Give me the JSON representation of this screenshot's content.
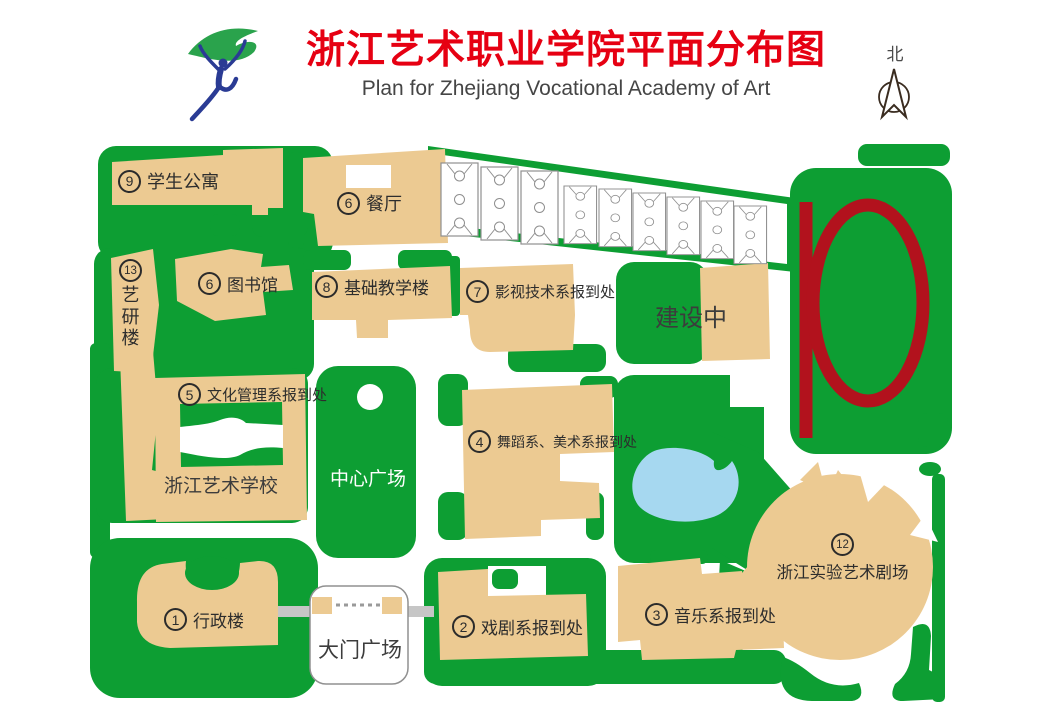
{
  "header": {
    "title_cn": "浙江艺术职业学院平面分布图",
    "title_en": "Plan for Zhejiang Vocational Academy of Art",
    "logo": "dancer-and-ribbon-logo"
  },
  "compass": {
    "label": "北"
  },
  "colors": {
    "lawn_green": "#0d9e33",
    "building_tan": "#ecca92",
    "track_red": "#b2121d",
    "pond_blue": "#a6d8f0",
    "title_red": "#e60012"
  },
  "map": {
    "labels": [
      {
        "num": "9",
        "text": "学生公寓"
      },
      {
        "num": "6",
        "text": "餐厅"
      },
      {
        "num": "13",
        "text": "艺研楼"
      },
      {
        "num": "6",
        "text": "图书馆"
      },
      {
        "num": "8",
        "text": "基础教学楼"
      },
      {
        "num": "7",
        "text": "影视技术系报到处"
      },
      {
        "num": "5",
        "text": "文化管理系报到处"
      },
      {
        "num": "4",
        "text": "舞蹈系、美术系报到处"
      },
      {
        "num": "12",
        "text": "浙江实验艺术剧场"
      },
      {
        "num": "1",
        "text": "行政楼"
      },
      {
        "num": "2",
        "text": "戏剧系报到处"
      },
      {
        "num": "3",
        "text": "音乐系报到处"
      }
    ],
    "areas": [
      {
        "text": "建设中"
      },
      {
        "text": "中心广场"
      },
      {
        "text": "浙江艺术学校"
      },
      {
        "text": "大门广场"
      }
    ],
    "features": {
      "basketball_courts": 9,
      "running_track": "red p-shaped track on green field",
      "pond": "pond",
      "fountain": "fountain",
      "gate": "main gate with two posts and dashed gate line"
    }
  }
}
